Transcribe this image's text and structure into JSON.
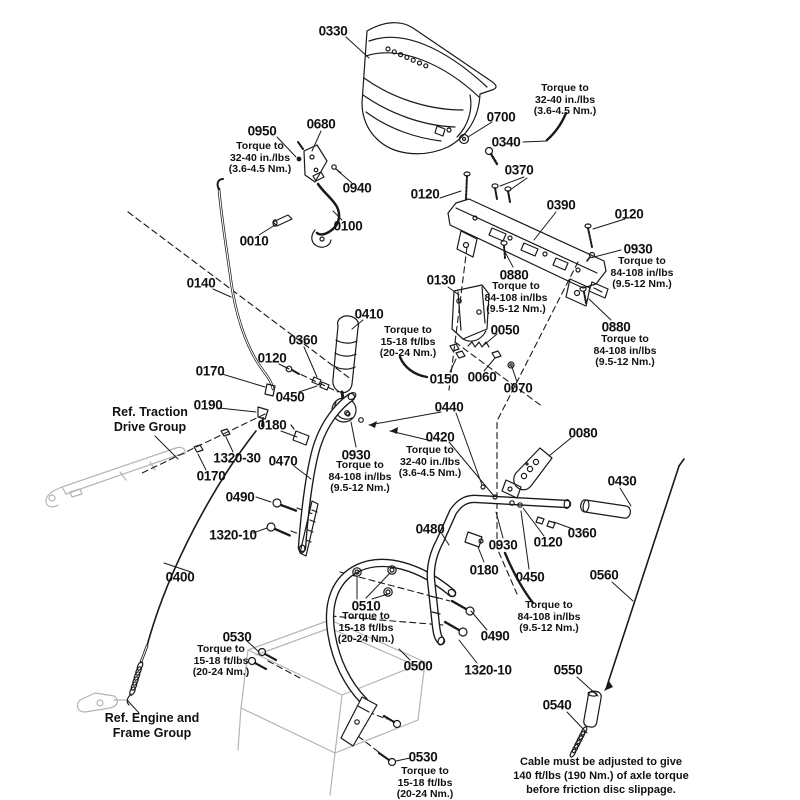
{
  "diagram": {
    "type": "exploded-parts-diagram",
    "colors": {
      "background": "#ffffff",
      "line": "#1a1a1a",
      "faint": "#b4b4b4",
      "text": "#111111"
    },
    "part_labels": [
      {
        "text": "0330",
        "x": 333,
        "y": 31
      },
      {
        "text": "0700",
        "x": 501,
        "y": 117
      },
      {
        "text": "0340",
        "x": 506,
        "y": 142
      },
      {
        "text": "0370",
        "x": 519,
        "y": 170
      },
      {
        "text": "0120",
        "x": 425,
        "y": 194
      },
      {
        "text": "0390",
        "x": 561,
        "y": 205
      },
      {
        "text": "0120",
        "x": 629,
        "y": 214
      },
      {
        "text": "0930",
        "x": 638,
        "y": 249
      },
      {
        "text": "0880",
        "x": 514,
        "y": 275
      },
      {
        "text": "0880",
        "x": 616,
        "y": 327
      },
      {
        "text": "0950",
        "x": 262,
        "y": 131
      },
      {
        "text": "0680",
        "x": 321,
        "y": 124
      },
      {
        "text": "0940",
        "x": 357,
        "y": 188
      },
      {
        "text": "0100",
        "x": 348,
        "y": 226
      },
      {
        "text": "0010",
        "x": 254,
        "y": 241
      },
      {
        "text": "0140",
        "x": 201,
        "y": 283
      },
      {
        "text": "0130",
        "x": 441,
        "y": 280
      },
      {
        "text": "0410",
        "x": 369,
        "y": 314
      },
      {
        "text": "0360",
        "x": 303,
        "y": 340
      },
      {
        "text": "0120",
        "x": 272,
        "y": 358
      },
      {
        "text": "0170",
        "x": 210,
        "y": 371
      },
      {
        "text": "0450",
        "x": 290,
        "y": 397
      },
      {
        "text": "0190",
        "x": 208,
        "y": 405
      },
      {
        "text": "0050",
        "x": 505,
        "y": 330
      },
      {
        "text": "0150",
        "x": 444,
        "y": 379
      },
      {
        "text": "0060",
        "x": 482,
        "y": 377
      },
      {
        "text": "0070",
        "x": 518,
        "y": 388
      },
      {
        "text": "0440",
        "x": 449,
        "y": 407
      },
      {
        "text": "0420",
        "x": 440,
        "y": 437
      },
      {
        "text": "0180",
        "x": 272,
        "y": 425
      },
      {
        "text": "1320-30",
        "x": 237,
        "y": 458
      },
      {
        "text": "0470",
        "x": 283,
        "y": 461
      },
      {
        "text": "0930",
        "x": 356,
        "y": 455
      },
      {
        "text": "0080",
        "x": 583,
        "y": 433
      },
      {
        "text": "0170",
        "x": 211,
        "y": 476
      },
      {
        "text": "0430",
        "x": 622,
        "y": 481
      },
      {
        "text": "0490",
        "x": 240,
        "y": 497
      },
      {
        "text": "0360",
        "x": 582,
        "y": 533
      },
      {
        "text": "1320-10",
        "x": 233,
        "y": 535
      },
      {
        "text": "0120",
        "x": 548,
        "y": 542
      },
      {
        "text": "0480",
        "x": 430,
        "y": 529
      },
      {
        "text": "0930",
        "x": 503,
        "y": 545
      },
      {
        "text": "0180",
        "x": 484,
        "y": 570
      },
      {
        "text": "0450",
        "x": 530,
        "y": 577
      },
      {
        "text": "0400",
        "x": 180,
        "y": 577
      },
      {
        "text": "0560",
        "x": 604,
        "y": 575
      },
      {
        "text": "0510",
        "x": 366,
        "y": 606
      },
      {
        "text": "0530",
        "x": 237,
        "y": 637
      },
      {
        "text": "0490",
        "x": 495,
        "y": 636
      },
      {
        "text": "0500",
        "x": 418,
        "y": 666
      },
      {
        "text": "1320-10",
        "x": 488,
        "y": 670
      },
      {
        "text": "0550",
        "x": 568,
        "y": 670
      },
      {
        "text": "0540",
        "x": 557,
        "y": 705
      },
      {
        "text": "0530",
        "x": 423,
        "y": 757
      }
    ],
    "torque_notes": [
      {
        "lines": [
          "Torque to",
          "32-40 in./lbs",
          "(3.6-4.5 Nm.)"
        ],
        "x": 565,
        "y": 100
      },
      {
        "lines": [
          "Torque to",
          "32-40 in./lbs",
          "(3.6-4.5 Nm.)"
        ],
        "x": 260,
        "y": 158
      },
      {
        "lines": [
          "Torque to",
          "84-108 in/lbs",
          "(9.5-12 Nm.)"
        ],
        "x": 642,
        "y": 273
      },
      {
        "lines": [
          "Torque to",
          "84-108 in/lbs",
          "(9.5-12 Nm.)"
        ],
        "x": 516,
        "y": 298
      },
      {
        "lines": [
          "Torque to",
          "84-108 in/lbs",
          "(9.5-12 Nm.)"
        ],
        "x": 625,
        "y": 351
      },
      {
        "lines": [
          "Torque to",
          "15-18 ft/lbs",
          "(20-24 Nm.)"
        ],
        "x": 408,
        "y": 342
      },
      {
        "lines": [
          "Torque to",
          "32-40 in./lbs",
          "(3.6-4.5 Nm.)"
        ],
        "x": 430,
        "y": 462
      },
      {
        "lines": [
          "Torque to",
          "84-108 in/lbs",
          "(9.5-12 Nm.)"
        ],
        "x": 360,
        "y": 477
      },
      {
        "lines": [
          "Torque to",
          "84-108 in/lbs",
          "(9.5-12 Nm.)"
        ],
        "x": 549,
        "y": 617
      },
      {
        "lines": [
          "Torque to",
          "15-18 ft/lbs",
          "(20-24 Nm.)"
        ],
        "x": 366,
        "y": 628
      },
      {
        "lines": [
          "Torque to",
          "15-18 ft/lbs",
          "(20-24 Nm.)"
        ],
        "x": 221,
        "y": 661
      },
      {
        "lines": [
          "Torque to",
          "15-18 ft/lbs",
          "(20-24 Nm.)"
        ],
        "x": 425,
        "y": 783
      }
    ],
    "ref_notes": [
      {
        "lines": [
          "Ref. Traction",
          "Drive Group"
        ],
        "x": 150,
        "y": 420
      },
      {
        "lines": [
          "Ref. Engine and",
          "Frame Group"
        ],
        "x": 152,
        "y": 726
      }
    ],
    "caption": {
      "lines": [
        "Cable must be adjusted to give",
        "140 ft/lbs (190 Nm.) of axle torque",
        "before friction disc slippage."
      ],
      "x": 601,
      "y": 776
    }
  }
}
